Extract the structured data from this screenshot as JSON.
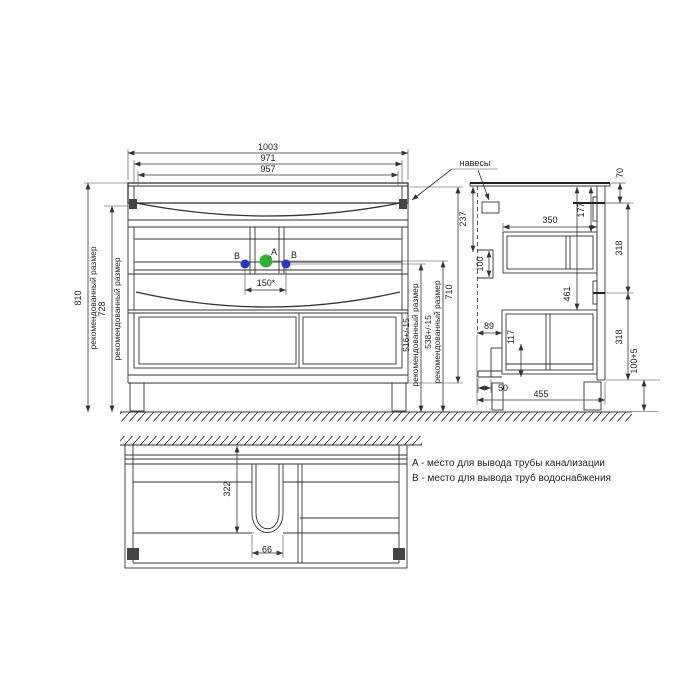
{
  "front_view": {
    "dims": {
      "w1003": "1003",
      "w971": "971",
      "w957": "957",
      "s150": "150*",
      "h810": "810",
      "h728": "728",
      "h516": "516+/-15",
      "h538": "538+/-15",
      "h710": "710",
      "recommended": "рекомендованный размер"
    },
    "markers": {
      "a": "A",
      "b": "B"
    }
  },
  "side_view": {
    "hangers_label": "навесы",
    "dims": {
      "d237": "237",
      "d70": "70",
      "d177": "177",
      "d350": "350",
      "d100": "100",
      "d461": "461",
      "d89": "89",
      "d117": "117",
      "d318_top": "318",
      "d318_bottom": "318",
      "legs": "100+5",
      "d50": "50",
      "d455": "455"
    }
  },
  "plan_view": {
    "dims": {
      "d322": "322",
      "d99": "99"
    }
  },
  "legend": {
    "line_a": "A - место для вывода трубы канализации",
    "line_b": "B - место для вывода труб водоснабжения"
  },
  "colors": {
    "marker_a": "#2bb52b",
    "marker_b": "#2634cf",
    "line": "#333333"
  }
}
